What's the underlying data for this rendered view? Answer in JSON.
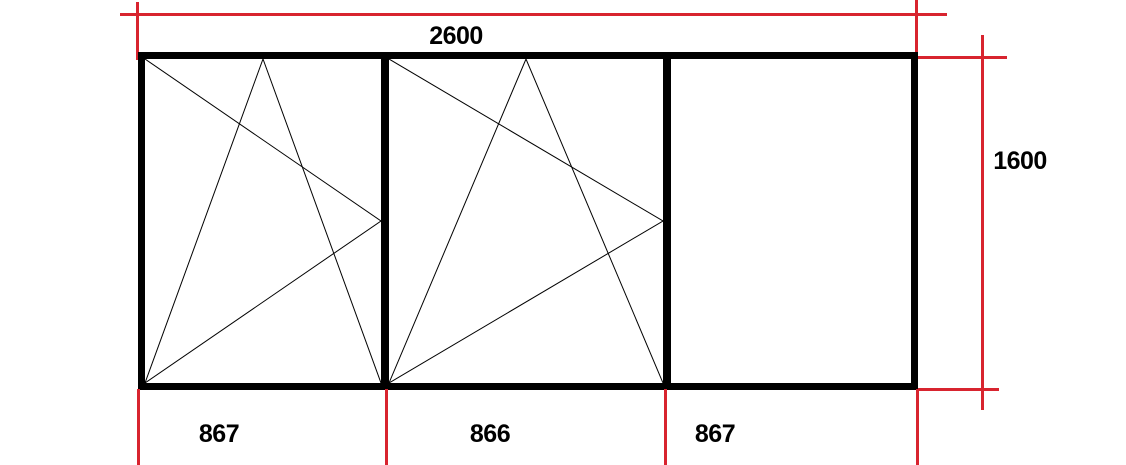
{
  "diagram": {
    "kind": "window-elevation-technical-drawing",
    "dimensions": {
      "total_width": "2600",
      "total_height": "1600",
      "panel_widths": [
        "867",
        "866",
        "867"
      ]
    },
    "panels": [
      {
        "id": 1,
        "type": "tilt-turn",
        "hinge_side": "left",
        "width_label": "867"
      },
      {
        "id": 2,
        "type": "tilt-turn",
        "hinge_side": "left",
        "width_label": "866"
      },
      {
        "id": 3,
        "type": "fixed",
        "hinge_side": "none",
        "width_label": "867"
      }
    ],
    "colors": {
      "frame": "#000000",
      "dimension_lines": "#d8242f",
      "symbol_lines": "#000000",
      "text": "#000000",
      "background": "#ffffff"
    }
  }
}
